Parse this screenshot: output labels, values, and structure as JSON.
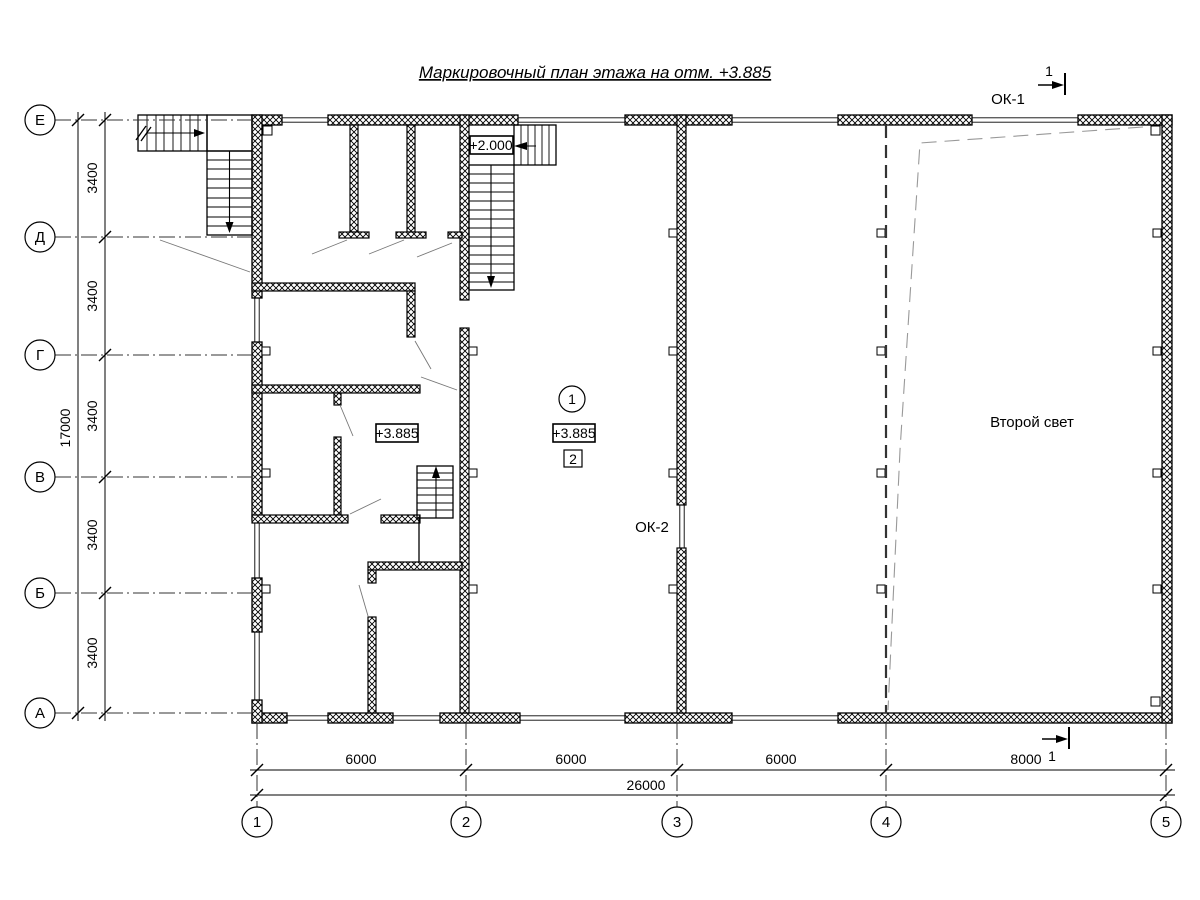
{
  "title": "Маркировочный план этажа на отм. +3.885",
  "axes": {
    "rows": [
      "Е",
      "Д",
      "Г",
      "В",
      "Б",
      "А"
    ],
    "cols": [
      "1",
      "2",
      "3",
      "4",
      "5"
    ]
  },
  "dimensions": {
    "row_spacings": [
      "3400",
      "3400",
      "3400",
      "3400",
      "3400"
    ],
    "row_total": "17000",
    "col_spacings": [
      "6000",
      "6000",
      "6000",
      "8000"
    ],
    "col_total": "26000"
  },
  "labels": {
    "window_type_1": "ОК-1",
    "window_type_2": "ОК-2",
    "double_height_space": "Второй свет",
    "elevation_landing": "+2.000",
    "elevation_floor_left": "+3.885",
    "elevation_floor_center": "+3.885",
    "room_number": "1",
    "node_marker": "2",
    "section_mark_top": "1",
    "section_mark_bottom": "1"
  },
  "colors": {
    "line": "#000000",
    "dash_heavy": "#333333",
    "dash_thin": "#999999"
  }
}
